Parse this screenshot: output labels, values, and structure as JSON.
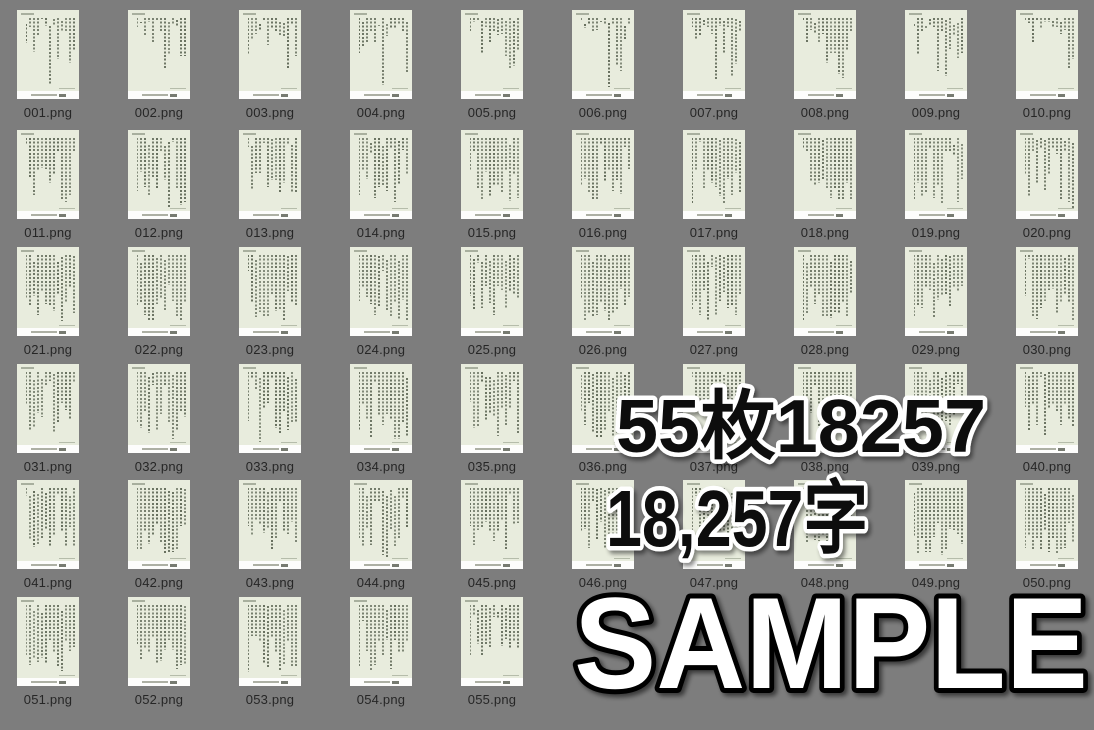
{
  "colors": {
    "background": "#7d7d7d",
    "thumbnail_page": "#e8ecdd",
    "thumbnail_footer": "#fdfdfc",
    "file_label_text": "#262626",
    "watermark_fill": "#0b0b0b",
    "watermark_outline": "#ffffff",
    "sample_fill": "#ffffff",
    "sample_outline": "#000000"
  },
  "files": [
    "001.png",
    "002.png",
    "003.png",
    "004.png",
    "005.png",
    "006.png",
    "007.png",
    "008.png",
    "009.png",
    "010.png",
    "011.png",
    "012.png",
    "013.png",
    "014.png",
    "015.png",
    "016.png",
    "017.png",
    "018.png",
    "019.png",
    "020.png",
    "021.png",
    "022.png",
    "023.png",
    "024.png",
    "025.png",
    "026.png",
    "027.png",
    "028.png",
    "029.png",
    "030.png",
    "031.png",
    "032.png",
    "033.png",
    "034.png",
    "035.png",
    "036.png",
    "037.png",
    "038.png",
    "039.png",
    "040.png",
    "041.png",
    "042.png",
    "043.png",
    "044.png",
    "045.png",
    "046.png",
    "047.png",
    "048.png",
    "049.png",
    "050.png",
    "051.png",
    "052.png",
    "053.png",
    "054.png",
    "055.png"
  ],
  "watermarks": {
    "page_count": "55枚18257",
    "char_count": "18,257字",
    "sample": "SAMPLE"
  }
}
